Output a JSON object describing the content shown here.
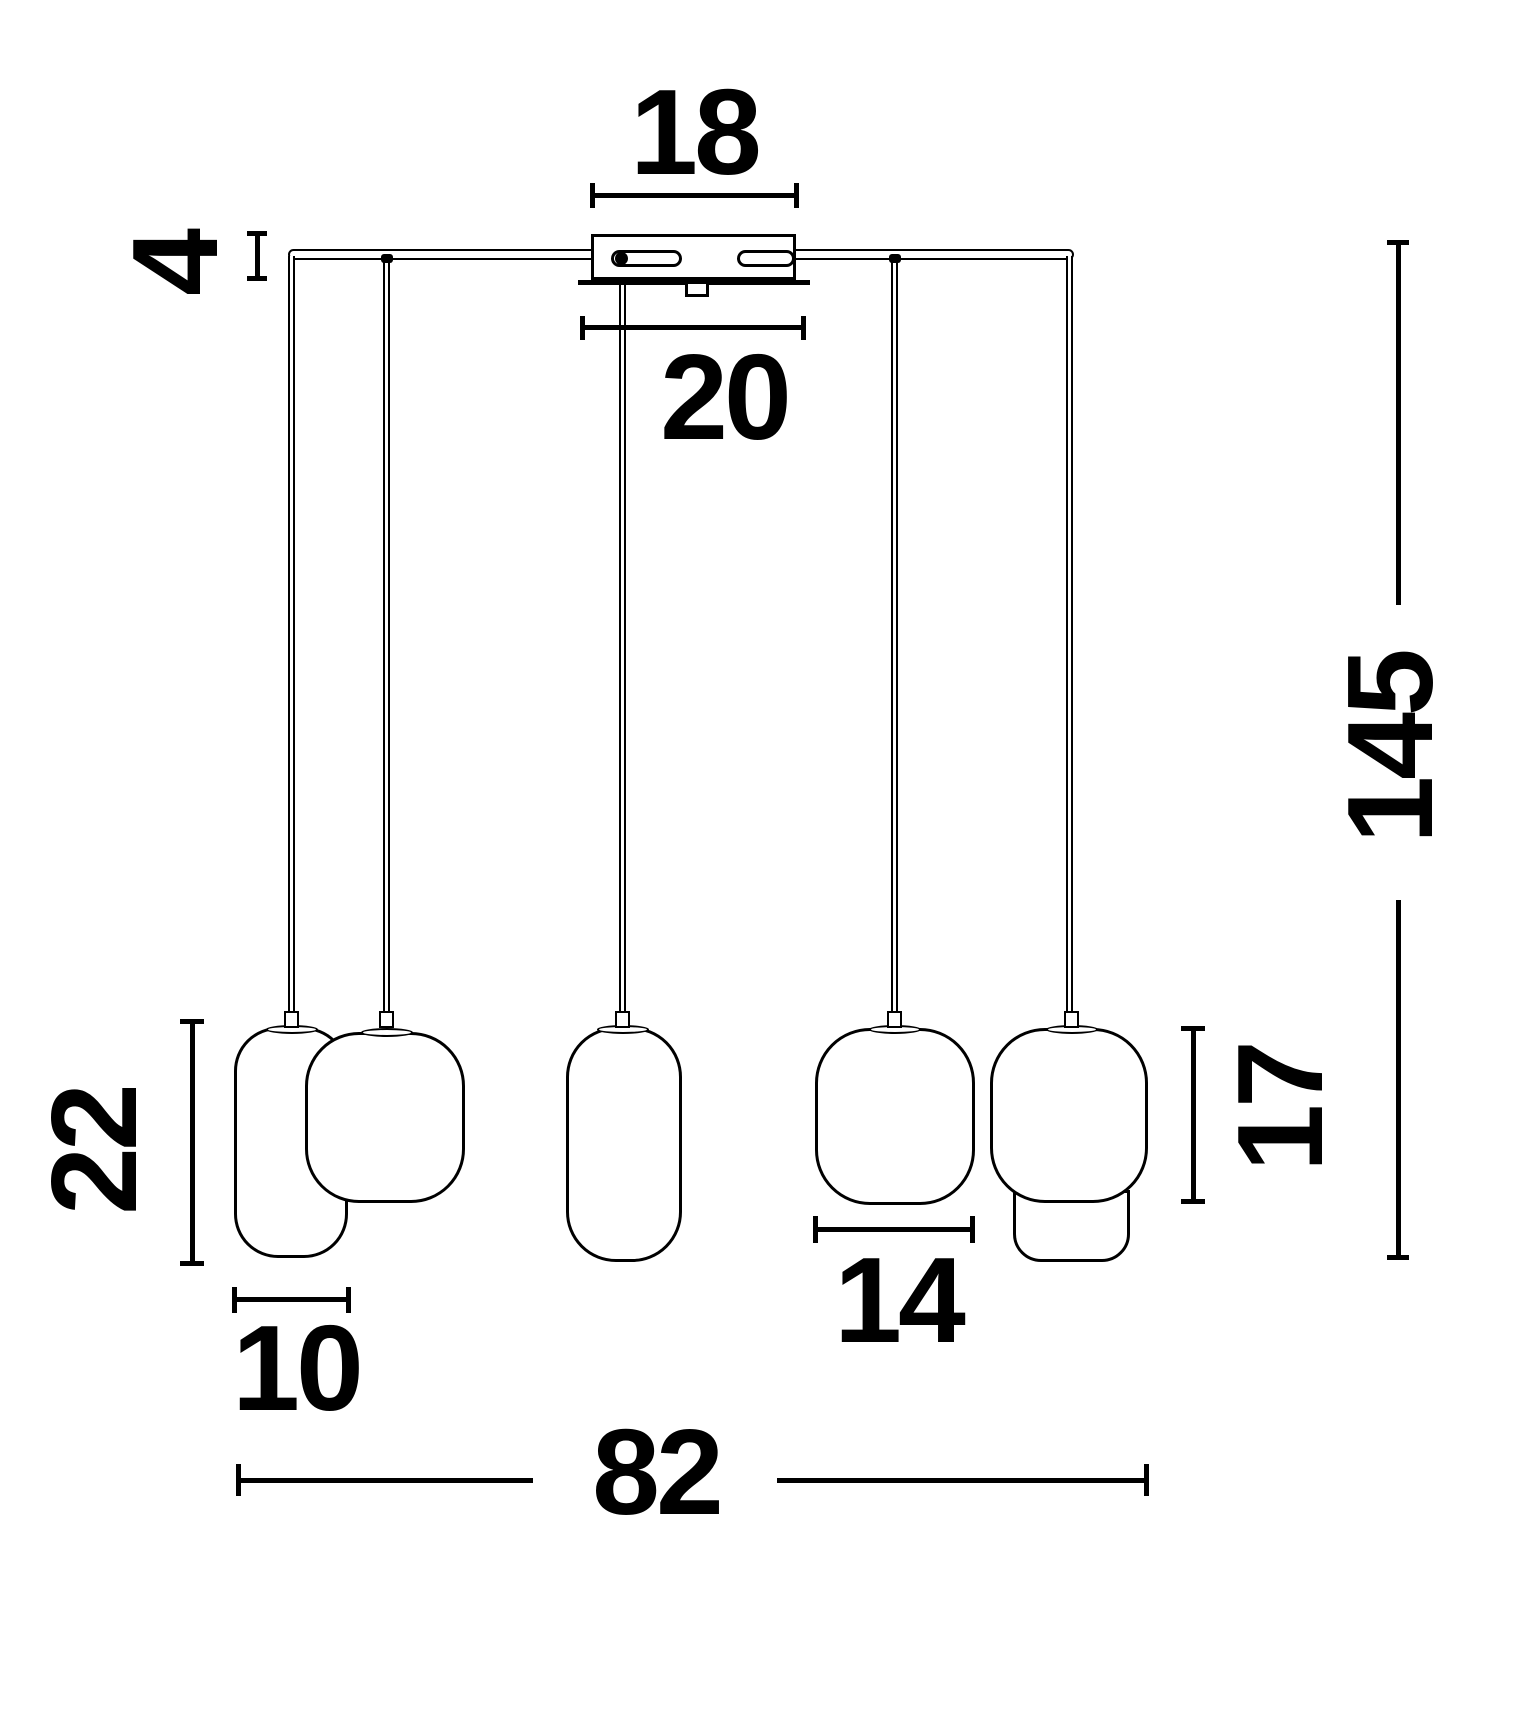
{
  "diagram": {
    "type": "technical-dimension-drawing",
    "dimensions": {
      "canopy_width": "18",
      "canopy_plate_width": "20",
      "canopy_height": "4",
      "suspension_height": "145",
      "left_shade_height": "22",
      "left_shade_width": "10",
      "right_shade_width": "14",
      "right_shade_height": "17",
      "total_width": "82"
    }
  }
}
